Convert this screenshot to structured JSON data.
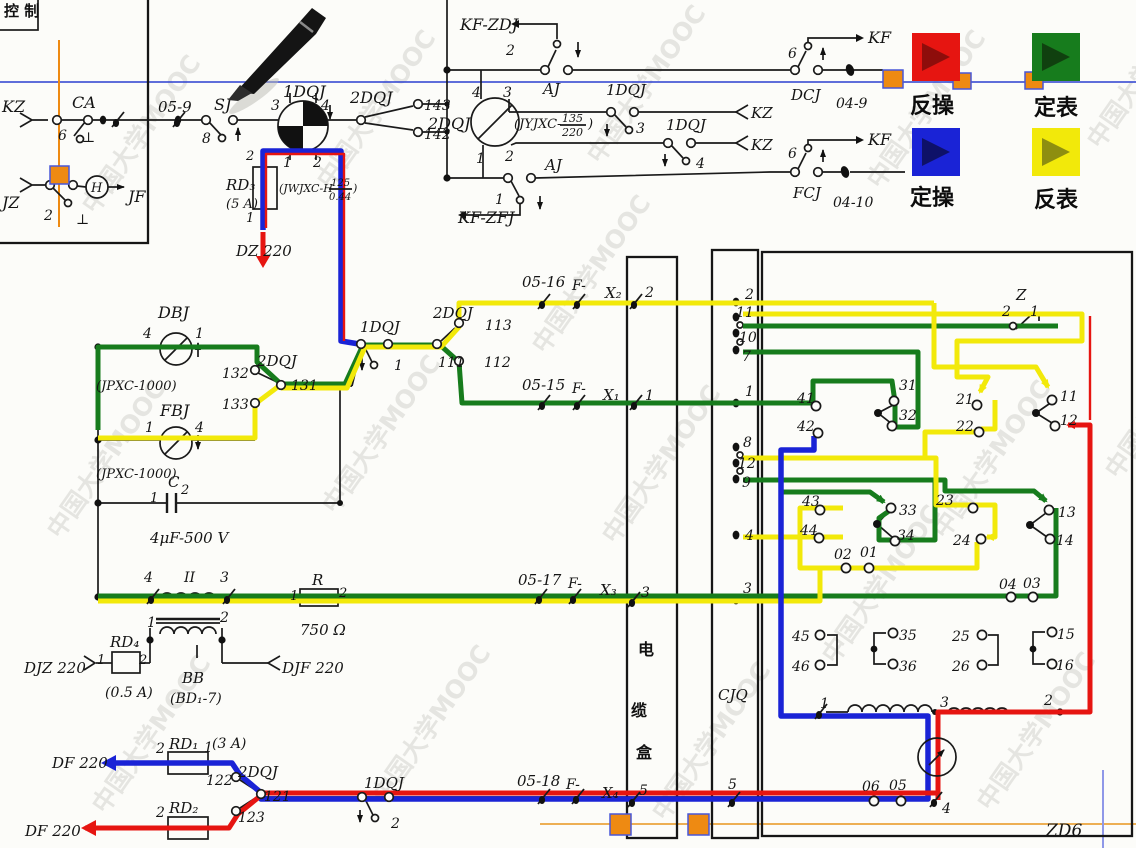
{
  "colors": {
    "red": "#e61511",
    "green": "#177c1d",
    "blue": "#1a23d6",
    "yellow": "#f2e90a",
    "red_dark": "#8e0d0b",
    "green_dark": "#10400f",
    "blue_dark": "#0e1168",
    "yellow_dark": "#8e8e10",
    "orange": "#ee8a12",
    "scan_line_blue": "#2b3fd0",
    "scan_line_orange": "#e8951d"
  },
  "legend": {
    "items": [
      {
        "label": "反操",
        "color": "#e61511",
        "arrow": "#8e0d0b"
      },
      {
        "label": "定表",
        "color": "#177c1d",
        "arrow": "#10400f"
      },
      {
        "label": "定操",
        "color": "#1a23d6",
        "arrow": "#0e1168"
      },
      {
        "label": "反表",
        "color": "#f2e90a",
        "arrow": "#8e8e10"
      }
    ]
  },
  "watermark": {
    "text": "中国大学MOOC"
  },
  "fractions": {
    "dqj1": {
      "pre": "(JWJXC-H",
      "num": "125",
      "den": "0.44",
      "post": ")"
    },
    "dqj2": {
      "pre": "(JYJXC-",
      "num": "135",
      "den": "220",
      "post": ")"
    }
  },
  "labels": [
    {
      "id": "kongzhi",
      "t": "控 制",
      "x": 4,
      "y": 16,
      "fs": 15,
      "cjk": true
    },
    {
      "id": "kz",
      "t": "KZ",
      "x": 2,
      "y": 112,
      "fs": 16
    },
    {
      "id": "ca",
      "t": "CA",
      "x": 72,
      "y": 108,
      "fs": 16
    },
    {
      "id": "ca-6",
      "t": "6",
      "x": 58,
      "y": 140
    },
    {
      "id": "ca-gnd",
      "t": "⊥",
      "x": 82,
      "y": 142
    },
    {
      "id": "jz",
      "t": "JZ",
      "x": 2,
      "y": 208,
      "fs": 16
    },
    {
      "id": "jz-2",
      "t": "2",
      "x": 44,
      "y": 220
    },
    {
      "id": "jz-gnd",
      "t": "⊥",
      "x": 76,
      "y": 224
    },
    {
      "id": "h-coil",
      "t": "H",
      "x": 91,
      "y": 192,
      "fs": 13
    },
    {
      "id": "jf",
      "t": "JF",
      "x": 128,
      "y": 202,
      "fs": 16
    },
    {
      "id": "c05-9",
      "t": "05-9",
      "x": 158,
      "y": 112,
      "fs": 15
    },
    {
      "id": "sj",
      "t": "SJ",
      "x": 214,
      "y": 110,
      "fs": 16
    },
    {
      "id": "sj-8",
      "t": "8",
      "x": 202,
      "y": 143
    },
    {
      "id": "dqj1",
      "t": "1DQJ",
      "x": 283,
      "y": 97,
      "fs": 16
    },
    {
      "id": "dqj1-p3",
      "t": "3",
      "x": 271,
      "y": 110
    },
    {
      "id": "dqj1-p4",
      "t": "4",
      "x": 321,
      "y": 110
    },
    {
      "id": "dqj1-p1",
      "t": "1",
      "x": 283,
      "y": 167
    },
    {
      "id": "dqj1-p2",
      "t": "2",
      "x": 313,
      "y": 167
    },
    {
      "id": "rd3-p2",
      "t": "2",
      "x": 246,
      "y": 160,
      "fs": 13
    },
    {
      "id": "rd3",
      "t": "RD₃",
      "x": 226,
      "y": 190,
      "fs": 15
    },
    {
      "id": "rd3-a",
      "t": "(5 A)",
      "x": 226,
      "y": 208,
      "fs": 13
    },
    {
      "id": "rd3-p1",
      "t": "1",
      "x": 246,
      "y": 222,
      "fs": 13
    },
    {
      "id": "dz220",
      "t": "DZ 220",
      "x": 236,
      "y": 256,
      "fs": 15
    },
    {
      "id": "dqj2-a",
      "t": "2DQJ",
      "x": 350,
      "y": 103,
      "fs": 16
    },
    {
      "id": "n143",
      "t": "143",
      "x": 424,
      "y": 110
    },
    {
      "id": "n142",
      "t": "142",
      "x": 424,
      "y": 139
    },
    {
      "id": "kf-zdj",
      "t": "KF-ZDJ",
      "x": 460,
      "y": 30,
      "fs": 16
    },
    {
      "id": "aj-2",
      "t": "2",
      "x": 506,
      "y": 55
    },
    {
      "id": "aj-top",
      "t": "AJ",
      "x": 543,
      "y": 94,
      "fs": 15
    },
    {
      "id": "dqj2-p4",
      "t": "4",
      "x": 472,
      "y": 97
    },
    {
      "id": "dqj2-p3",
      "t": "3",
      "x": 503,
      "y": 97
    },
    {
      "id": "dqj2",
      "t": "2DQJ",
      "x": 428,
      "y": 129,
      "fs": 16
    },
    {
      "id": "dqj2-p1",
      "t": "1",
      "x": 476,
      "y": 163
    },
    {
      "id": "dqj2-p2",
      "t": "2",
      "x": 505,
      "y": 161
    },
    {
      "id": "dqj1-b",
      "t": "1DQJ",
      "x": 606,
      "y": 95,
      "fs": 15
    },
    {
      "id": "dqj1-b3",
      "t": "3",
      "x": 636,
      "y": 133
    },
    {
      "id": "kz-b1",
      "t": "KZ",
      "x": 751,
      "y": 118,
      "fs": 15
    },
    {
      "id": "dqj1-c",
      "t": "1DQJ",
      "x": 666,
      "y": 130,
      "fs": 15
    },
    {
      "id": "dqj1-c4",
      "t": "4",
      "x": 696,
      "y": 168
    },
    {
      "id": "kz-b2",
      "t": "KZ",
      "x": 751,
      "y": 150,
      "fs": 15
    },
    {
      "id": "aj-bot",
      "t": "AJ",
      "x": 545,
      "y": 170,
      "fs": 15
    },
    {
      "id": "aj-1",
      "t": "1",
      "x": 495,
      "y": 204
    },
    {
      "id": "kf-zfj",
      "t": "KF-ZFJ",
      "x": 458,
      "y": 223,
      "fs": 16
    },
    {
      "id": "dcj-6",
      "t": "6",
      "x": 788,
      "y": 58
    },
    {
      "id": "kf-1",
      "t": "KF",
      "x": 868,
      "y": 43,
      "fs": 16
    },
    {
      "id": "dcj",
      "t": "DCJ",
      "x": 791,
      "y": 100,
      "fs": 15
    },
    {
      "id": "c04-9",
      "t": "04-9",
      "x": 836,
      "y": 108
    },
    {
      "id": "fcj-6",
      "t": "6",
      "x": 788,
      "y": 158
    },
    {
      "id": "kf-2",
      "t": "KF",
      "x": 868,
      "y": 145,
      "fs": 16
    },
    {
      "id": "fcj",
      "t": "FCJ",
      "x": 793,
      "y": 198,
      "fs": 15
    },
    {
      "id": "c04-10",
      "t": "04-10",
      "x": 833,
      "y": 207
    },
    {
      "id": "dbj",
      "t": "DBJ",
      "x": 158,
      "y": 318,
      "fs": 16
    },
    {
      "id": "dbj-4",
      "t": "4",
      "x": 143,
      "y": 338
    },
    {
      "id": "dbj-1",
      "t": "1",
      "x": 195,
      "y": 338
    },
    {
      "id": "jpxc-1",
      "t": "(JPXC-1000)",
      "x": 96,
      "y": 390,
      "fs": 13
    },
    {
      "id": "n132",
      "t": "132",
      "x": 222,
      "y": 378
    },
    {
      "id": "dqj2-b",
      "t": "2DQJ",
      "x": 257,
      "y": 366,
      "fs": 15
    },
    {
      "id": "n131",
      "t": "131",
      "x": 291,
      "y": 390
    },
    {
      "id": "n133",
      "t": "133",
      "x": 222,
      "y": 409
    },
    {
      "id": "fbj",
      "t": "FBJ",
      "x": 160,
      "y": 416,
      "fs": 16
    },
    {
      "id": "fbj-1",
      "t": "1",
      "x": 145,
      "y": 432
    },
    {
      "id": "fbj-4",
      "t": "4",
      "x": 195,
      "y": 432
    },
    {
      "id": "jpxc-2",
      "t": "(JPXC-1000)",
      "x": 96,
      "y": 478,
      "fs": 13
    },
    {
      "id": "cap-c",
      "t": "C",
      "x": 168,
      "y": 487,
      "fs": 15
    },
    {
      "id": "cap-2",
      "t": "2",
      "x": 181,
      "y": 494,
      "fs": 13
    },
    {
      "id": "cap-1",
      "t": "1",
      "x": 150,
      "y": 502,
      "fs": 13
    },
    {
      "id": "cap-v",
      "t": "4μF-500 V",
      "x": 150,
      "y": 543,
      "fs": 15
    },
    {
      "id": "dqj1-d",
      "t": "1DQJ",
      "x": 360,
      "y": 332,
      "fs": 15
    },
    {
      "id": "dqj1-d1",
      "t": "1",
      "x": 394,
      "y": 370
    },
    {
      "id": "dqj2-c",
      "t": "2DQJ",
      "x": 433,
      "y": 318,
      "fs": 15
    },
    {
      "id": "n113",
      "t": "113",
      "x": 485,
      "y": 330
    },
    {
      "id": "n111",
      "t": "111",
      "x": 438,
      "y": 367
    },
    {
      "id": "n112",
      "t": "112",
      "x": 484,
      "y": 367
    },
    {
      "id": "c05-16",
      "t": "05-16",
      "x": 522,
      "y": 287,
      "fs": 15
    },
    {
      "id": "f-1",
      "t": "F-",
      "x": 572,
      "y": 290
    },
    {
      "id": "x2",
      "t": "X₂",
      "x": 605,
      "y": 298,
      "fs": 15
    },
    {
      "id": "x2-2",
      "t": "2",
      "x": 645,
      "y": 297
    },
    {
      "id": "c05-15",
      "t": "05-15",
      "x": 522,
      "y": 390,
      "fs": 15
    },
    {
      "id": "f-2",
      "t": "F-",
      "x": 572,
      "y": 393
    },
    {
      "id": "x1",
      "t": "X₁",
      "x": 603,
      "y": 400,
      "fs": 15
    },
    {
      "id": "x1-1",
      "t": "1",
      "x": 645,
      "y": 400
    },
    {
      "id": "c05-17",
      "t": "05-17",
      "x": 518,
      "y": 585,
      "fs": 15
    },
    {
      "id": "f-3",
      "t": "F-",
      "x": 568,
      "y": 588
    },
    {
      "id": "x3",
      "t": "X₃",
      "x": 600,
      "y": 595,
      "fs": 15
    },
    {
      "id": "x3-3",
      "t": "3",
      "x": 641,
      "y": 597
    },
    {
      "id": "tr-4",
      "t": "4",
      "x": 144,
      "y": 582
    },
    {
      "id": "tr-ii",
      "t": "II",
      "x": 184,
      "y": 582
    },
    {
      "id": "tr-3",
      "t": "3",
      "x": 220,
      "y": 582
    },
    {
      "id": "tr-1",
      "t": "1",
      "x": 147,
      "y": 627
    },
    {
      "id": "tr-2",
      "t": "2",
      "x": 220,
      "y": 622
    },
    {
      "id": "bb",
      "t": "BB",
      "x": 182,
      "y": 683,
      "fs": 15
    },
    {
      "id": "bd1-7",
      "t": "(BD₁-7)",
      "x": 170,
      "y": 703
    },
    {
      "id": "res-r",
      "t": "R",
      "x": 312,
      "y": 585,
      "fs": 15
    },
    {
      "id": "r-1",
      "t": "1",
      "x": 290,
      "y": 600,
      "fs": 13
    },
    {
      "id": "r-2",
      "t": "2",
      "x": 339,
      "y": 597,
      "fs": 13
    },
    {
      "id": "r-ohm",
      "t": "750 Ω",
      "x": 300,
      "y": 635,
      "fs": 15
    },
    {
      "id": "rd4",
      "t": "RD₄",
      "x": 110,
      "y": 647,
      "fs": 15
    },
    {
      "id": "rd4-1",
      "t": "1",
      "x": 97,
      "y": 664,
      "fs": 13
    },
    {
      "id": "rd4-2",
      "t": "2",
      "x": 139,
      "y": 664,
      "fs": 13
    },
    {
      "id": "djz220",
      "t": "DJZ 220",
      "x": 24,
      "y": 673,
      "fs": 15
    },
    {
      "id": "rd4-a",
      "t": "(0.5 A)",
      "x": 105,
      "y": 697
    },
    {
      "id": "djf220",
      "t": "DJF 220",
      "x": 282,
      "y": 673,
      "fs": 15
    },
    {
      "id": "rd1-2",
      "t": "2",
      "x": 156,
      "y": 753
    },
    {
      "id": "rd1",
      "t": "RD₁",
      "x": 169,
      "y": 749,
      "fs": 15
    },
    {
      "id": "rd1-1",
      "t": "1",
      "x": 204,
      "y": 752
    },
    {
      "id": "rd1-a",
      "t": "(3 A)",
      "x": 212,
      "y": 748
    },
    {
      "id": "df220-b",
      "t": "DF 220",
      "x": 52,
      "y": 768,
      "fs": 15
    },
    {
      "id": "n122",
      "t": "122",
      "x": 206,
      "y": 785
    },
    {
      "id": "dqj2-d",
      "t": "2DQJ",
      "x": 238,
      "y": 777,
      "fs": 15
    },
    {
      "id": "n121",
      "t": "121",
      "x": 264,
      "y": 801
    },
    {
      "id": "rd2-2",
      "t": "2",
      "x": 156,
      "y": 817
    },
    {
      "id": "rd2",
      "t": "RD₂",
      "x": 169,
      "y": 813,
      "fs": 15
    },
    {
      "id": "n123",
      "t": "123",
      "x": 238,
      "y": 822
    },
    {
      "id": "df220-r",
      "t": "DF 220",
      "x": 25,
      "y": 836,
      "fs": 15
    },
    {
      "id": "dqj1-e",
      "t": "1DQJ",
      "x": 364,
      "y": 788,
      "fs": 15
    },
    {
      "id": "dqj1-e2",
      "t": "2",
      "x": 391,
      "y": 828
    },
    {
      "id": "c05-18",
      "t": "05-18",
      "x": 517,
      "y": 786,
      "fs": 15
    },
    {
      "id": "f-4",
      "t": "F-",
      "x": 566,
      "y": 789
    },
    {
      "id": "x4",
      "t": "X₄",
      "x": 602,
      "y": 798,
      "fs": 15
    },
    {
      "id": "x4-5",
      "t": "5",
      "x": 639,
      "y": 795
    },
    {
      "id": "cable-1",
      "t": "电",
      "x": 638,
      "y": 655,
      "fs": 16,
      "cjk": true
    },
    {
      "id": "cable-2",
      "t": "缆",
      "x": 631,
      "y": 716,
      "fs": 16,
      "cjk": true
    },
    {
      "id": "cable-3",
      "t": "盒",
      "x": 636,
      "y": 758,
      "fs": 16,
      "cjk": true
    },
    {
      "id": "cjq-2",
      "t": "2",
      "x": 745,
      "y": 299
    },
    {
      "id": "cjq-11",
      "t": "11",
      "x": 736,
      "y": 317
    },
    {
      "id": "cjq-10",
      "t": "10",
      "x": 739,
      "y": 342
    },
    {
      "id": "cjq-7",
      "t": "7",
      "x": 742,
      "y": 361
    },
    {
      "id": "cjq-1",
      "t": "1",
      "x": 745,
      "y": 396
    },
    {
      "id": "cjq-8",
      "t": "8",
      "x": 743,
      "y": 447
    },
    {
      "id": "cjq-12",
      "t": "12",
      "x": 738,
      "y": 468
    },
    {
      "id": "cjq-9",
      "t": "9",
      "x": 742,
      "y": 487
    },
    {
      "id": "cjq-4",
      "t": "4",
      "x": 745,
      "y": 540
    },
    {
      "id": "cjq-3",
      "t": "3",
      "x": 743,
      "y": 593
    },
    {
      "id": "cjq-5",
      "t": "5",
      "x": 728,
      "y": 789
    },
    {
      "id": "cjq",
      "t": "CJQ",
      "x": 718,
      "y": 700,
      "fs": 15
    },
    {
      "id": "z",
      "t": "Z",
      "x": 1016,
      "y": 300,
      "fs": 15
    },
    {
      "id": "z-2",
      "t": "2",
      "x": 1002,
      "y": 316
    },
    {
      "id": "z-1",
      "t": "1",
      "x": 1030,
      "y": 316
    },
    {
      "id": "k41",
      "t": "41",
      "x": 797,
      "y": 403
    },
    {
      "id": "k42",
      "t": "42",
      "x": 797,
      "y": 431
    },
    {
      "id": "k31",
      "t": "31",
      "x": 899,
      "y": 390
    },
    {
      "id": "k32",
      "t": "32",
      "x": 899,
      "y": 420
    },
    {
      "id": "k21",
      "t": "21",
      "x": 956,
      "y": 404
    },
    {
      "id": "k22",
      "t": "22",
      "x": 956,
      "y": 431
    },
    {
      "id": "k11",
      "t": "11",
      "x": 1060,
      "y": 401
    },
    {
      "id": "k12",
      "t": "12",
      "x": 1060,
      "y": 425
    },
    {
      "id": "k43",
      "t": "43",
      "x": 802,
      "y": 506
    },
    {
      "id": "k44",
      "t": "44",
      "x": 800,
      "y": 535
    },
    {
      "id": "k33",
      "t": "33",
      "x": 899,
      "y": 515
    },
    {
      "id": "k34",
      "t": "34",
      "x": 897,
      "y": 540
    },
    {
      "id": "k23",
      "t": "23",
      "x": 936,
      "y": 505
    },
    {
      "id": "k24",
      "t": "24",
      "x": 953,
      "y": 545
    },
    {
      "id": "k13",
      "t": "13",
      "x": 1058,
      "y": 517
    },
    {
      "id": "k14",
      "t": "14",
      "x": 1056,
      "y": 545
    },
    {
      "id": "k02",
      "t": "02",
      "x": 834,
      "y": 559
    },
    {
      "id": "k01",
      "t": "01",
      "x": 860,
      "y": 557
    },
    {
      "id": "k04",
      "t": "04",
      "x": 999,
      "y": 589
    },
    {
      "id": "k03",
      "t": "03",
      "x": 1023,
      "y": 588
    },
    {
      "id": "k45",
      "t": "45",
      "x": 792,
      "y": 641
    },
    {
      "id": "k46",
      "t": "46",
      "x": 792,
      "y": 671
    },
    {
      "id": "k35",
      "t": "35",
      "x": 899,
      "y": 640
    },
    {
      "id": "k36",
      "t": "36",
      "x": 899,
      "y": 671
    },
    {
      "id": "k25",
      "t": "25",
      "x": 952,
      "y": 641
    },
    {
      "id": "k26",
      "t": "26",
      "x": 952,
      "y": 671
    },
    {
      "id": "k15",
      "t": "15",
      "x": 1057,
      "y": 639
    },
    {
      "id": "k16",
      "t": "16",
      "x": 1056,
      "y": 670
    },
    {
      "id": "mot-1",
      "t": "1",
      "x": 820,
      "y": 708
    },
    {
      "id": "mot-3",
      "t": "3",
      "x": 940,
      "y": 707
    },
    {
      "id": "mot-2",
      "t": "2",
      "x": 1044,
      "y": 705
    },
    {
      "id": "k06",
      "t": "06",
      "x": 862,
      "y": 791
    },
    {
      "id": "k05",
      "t": "05",
      "x": 889,
      "y": 790
    },
    {
      "id": "mot-4",
      "t": "4",
      "x": 942,
      "y": 813
    },
    {
      "id": "zd6",
      "t": "ZD6",
      "x": 1046,
      "y": 836,
      "fs": 17
    }
  ]
}
